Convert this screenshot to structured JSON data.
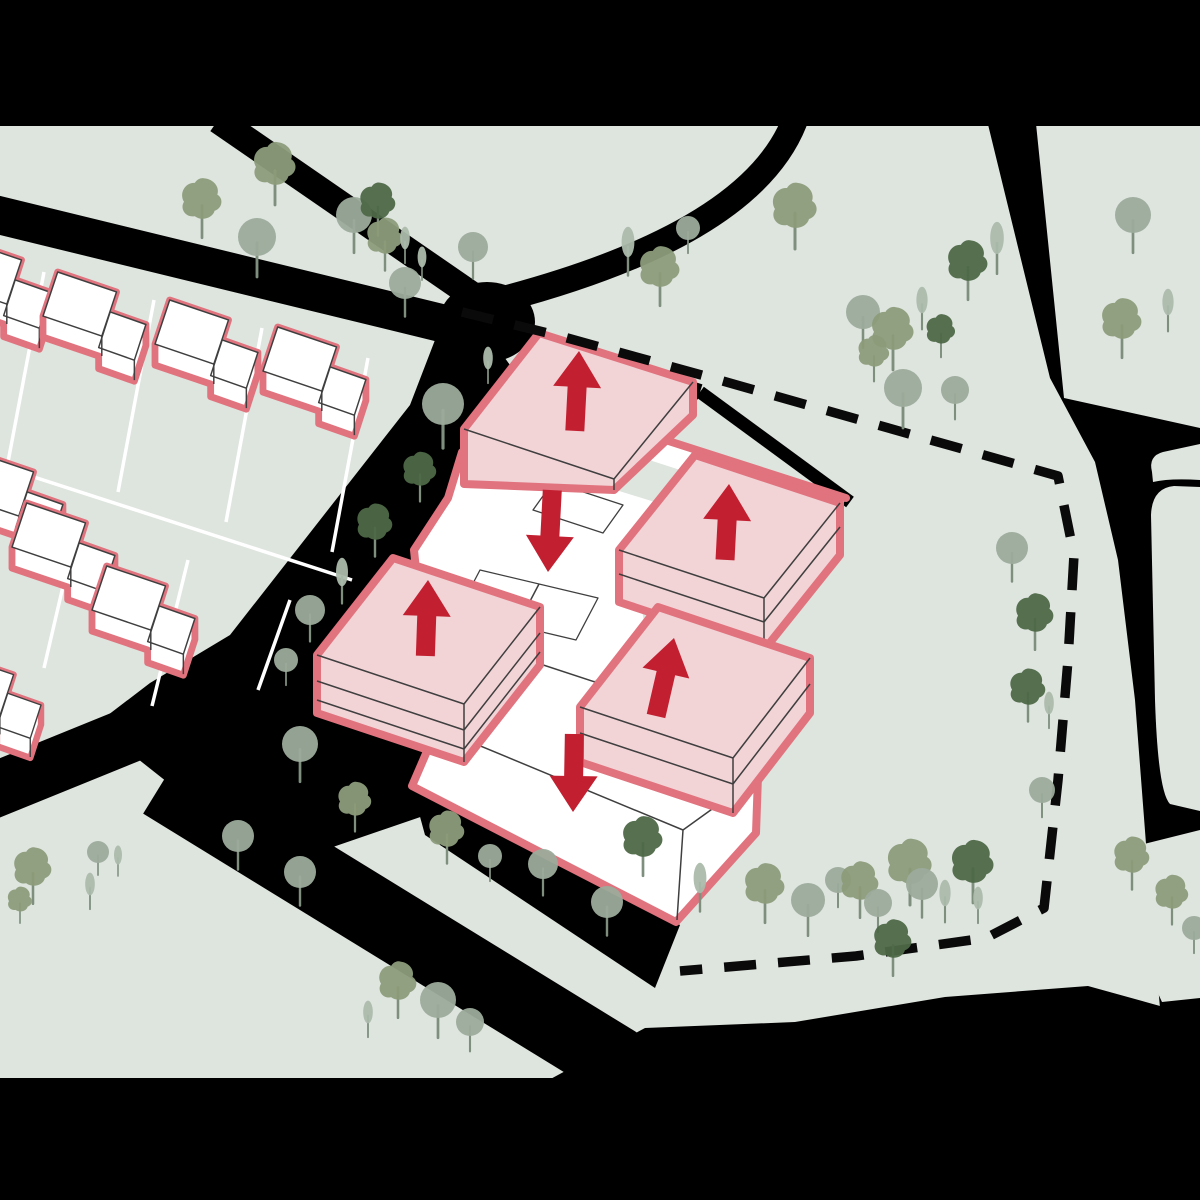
{
  "diagram": {
    "kind": "architectural-site-massing-diagram",
    "description": "Axonometric urban site diagram: existing houses outlined pink at top-left, a central school/cluster of massing blocks with red arrows (pink blocks = volumes added/up, white blocks = volumes reduced/down), dashed site boundary, black roads, scattered trees",
    "colors": {
      "ground": "#dee4de",
      "road": "#000000",
      "pink_fill": "#f2d3d6",
      "pink_outline": "#e0737e",
      "arrow_red": "#c22031",
      "white": "#ffffff",
      "line_dark": "#3f3f3f",
      "plot_line": "#ffffff",
      "boundary": "#0a0a0a",
      "tree_light": "#9cab9b",
      "tree_olive": "#8c9c7a",
      "tree_dark": "#4d6847",
      "tree_pale": "#abbaab",
      "trunk": "#7e8f7e"
    },
    "site_boundary": {
      "style": "dashed",
      "dash": [
        32,
        22
      ],
      "points": [
        [
          462,
          312
        ],
        [
          560,
          336
        ],
        [
          705,
          376
        ],
        [
          860,
          420
        ],
        [
          1058,
          476
        ],
        [
          1074,
          555
        ],
        [
          1068,
          660
        ],
        [
          1058,
          780
        ],
        [
          1044,
          908
        ],
        [
          986,
          938
        ],
        [
          856,
          956
        ],
        [
          680,
          971
        ]
      ]
    },
    "massing_blocks": [
      {
        "id": "block-north",
        "fill": "pink",
        "change": "up"
      },
      {
        "id": "block-east",
        "fill": "pink",
        "change": "up"
      },
      {
        "id": "block-west",
        "fill": "pink",
        "change": "up"
      },
      {
        "id": "block-southeast",
        "fill": "pink",
        "change": "up"
      },
      {
        "id": "podium-centre",
        "fill": "white",
        "change": "down"
      },
      {
        "id": "podium-south",
        "fill": "white",
        "change": "down"
      }
    ],
    "arrows": [
      {
        "block": "block-north",
        "dir": "up",
        "tip": [
          579,
          351
        ],
        "len": 80,
        "rot": 3
      },
      {
        "block": "block-east",
        "dir": "up",
        "tip": [
          729,
          484
        ],
        "len": 76,
        "rot": 3
      },
      {
        "block": "block-west",
        "dir": "up",
        "tip": [
          428,
          580
        ],
        "len": 76,
        "rot": 2
      },
      {
        "block": "block-southeast",
        "dir": "up",
        "tip": [
          674,
          638
        ],
        "len": 80,
        "rot": 13
      },
      {
        "block": "podium-centre",
        "dir": "down",
        "tip": [
          548,
          572
        ],
        "len": 82,
        "rot": 3
      },
      {
        "block": "podium-south",
        "dir": "down",
        "tip": [
          573,
          812
        ],
        "len": 78,
        "rot": 1
      }
    ],
    "houses": [
      {
        "x": -52,
        "y": 240,
        "s": 1.05
      },
      {
        "x": 43,
        "y": 272,
        "s": 1.05
      },
      {
        "x": 155,
        "y": 300,
        "s": 1.05
      },
      {
        "x": 263,
        "y": 327,
        "s": 1.05
      },
      {
        "x": -40,
        "y": 452,
        "s": 1.05
      },
      {
        "x": 12,
        "y": 503,
        "s": 1.05
      },
      {
        "x": 92,
        "y": 566,
        "s": 1.05
      },
      {
        "x": -55,
        "y": 656,
        "s": 0.98
      }
    ],
    "trees": [
      {
        "x": 202,
        "y": 200,
        "k": "blob",
        "s": 0.9
      },
      {
        "x": 275,
        "y": 165,
        "k": "blob",
        "s": 0.95
      },
      {
        "x": 257,
        "y": 237,
        "k": "round",
        "s": 0.95
      },
      {
        "x": 354,
        "y": 215,
        "k": "round",
        "s": 0.9
      },
      {
        "x": 378,
        "y": 202,
        "k": "blobdark",
        "s": 0.8
      },
      {
        "x": 385,
        "y": 237,
        "k": "blob",
        "s": 0.8
      },
      {
        "x": 405,
        "y": 238,
        "k": "column",
        "s": 0.6
      },
      {
        "x": 422,
        "y": 257,
        "k": "column",
        "s": 0.55
      },
      {
        "x": 473,
        "y": 247,
        "k": "round",
        "s": 0.75
      },
      {
        "x": 405,
        "y": 283,
        "k": "round",
        "s": 0.8
      },
      {
        "x": 628,
        "y": 242,
        "k": "column",
        "s": 0.8
      },
      {
        "x": 660,
        "y": 268,
        "k": "blob",
        "s": 0.9
      },
      {
        "x": 688,
        "y": 228,
        "k": "round",
        "s": 0.6
      },
      {
        "x": 795,
        "y": 207,
        "k": "blob",
        "s": 1.0
      },
      {
        "x": 968,
        "y": 262,
        "k": "blobdark",
        "s": 0.9
      },
      {
        "x": 997,
        "y": 238,
        "k": "column",
        "s": 0.85
      },
      {
        "x": 488,
        "y": 358,
        "k": "column",
        "s": 0.6
      },
      {
        "x": 1133,
        "y": 215,
        "k": "round",
        "s": 0.9
      },
      {
        "x": 1122,
        "y": 320,
        "k": "blob",
        "s": 0.9
      },
      {
        "x": 1168,
        "y": 302,
        "k": "column",
        "s": 0.7
      },
      {
        "x": 863,
        "y": 312,
        "k": "round",
        "s": 0.85
      },
      {
        "x": 893,
        "y": 330,
        "k": "blob",
        "s": 0.95
      },
      {
        "x": 922,
        "y": 300,
        "k": "column",
        "s": 0.7
      },
      {
        "x": 941,
        "y": 330,
        "k": "blobdark",
        "s": 0.65
      },
      {
        "x": 903,
        "y": 388,
        "k": "round",
        "s": 0.95
      },
      {
        "x": 955,
        "y": 390,
        "k": "round",
        "s": 0.7
      },
      {
        "x": 874,
        "y": 352,
        "k": "blob",
        "s": 0.7
      },
      {
        "x": 1012,
        "y": 548,
        "k": "round",
        "s": 0.8
      },
      {
        "x": 1035,
        "y": 614,
        "k": "blobdark",
        "s": 0.85
      },
      {
        "x": 1028,
        "y": 688,
        "k": "blobdark",
        "s": 0.8
      },
      {
        "x": 1049,
        "y": 703,
        "k": "column",
        "s": 0.6
      },
      {
        "x": 1042,
        "y": 790,
        "k": "round",
        "s": 0.65
      },
      {
        "x": 443,
        "y": 404,
        "k": "round",
        "s": 1.05
      },
      {
        "x": 420,
        "y": 470,
        "k": "blobdark",
        "s": 0.75
      },
      {
        "x": 375,
        "y": 523,
        "k": "blobdark",
        "s": 0.8
      },
      {
        "x": 342,
        "y": 572,
        "k": "column",
        "s": 0.75
      },
      {
        "x": 310,
        "y": 610,
        "k": "round",
        "s": 0.75
      },
      {
        "x": 286,
        "y": 660,
        "k": "round",
        "s": 0.6
      },
      {
        "x": 300,
        "y": 744,
        "k": "round",
        "s": 0.9
      },
      {
        "x": 355,
        "y": 800,
        "k": "blob",
        "s": 0.75
      },
      {
        "x": 447,
        "y": 830,
        "k": "blob",
        "s": 0.8
      },
      {
        "x": 490,
        "y": 856,
        "k": "round",
        "s": 0.6
      },
      {
        "x": 543,
        "y": 864,
        "k": "round",
        "s": 0.75
      },
      {
        "x": 607,
        "y": 902,
        "k": "round",
        "s": 0.8
      },
      {
        "x": 643,
        "y": 838,
        "k": "blobdark",
        "s": 0.9
      },
      {
        "x": 700,
        "y": 878,
        "k": "column",
        "s": 0.8
      },
      {
        "x": 765,
        "y": 885,
        "k": "blob",
        "s": 0.9
      },
      {
        "x": 808,
        "y": 900,
        "k": "round",
        "s": 0.85
      },
      {
        "x": 838,
        "y": 880,
        "k": "round",
        "s": 0.65
      },
      {
        "x": 860,
        "y": 882,
        "k": "blob",
        "s": 0.85
      },
      {
        "x": 878,
        "y": 903,
        "k": "round",
        "s": 0.7
      },
      {
        "x": 910,
        "y": 863,
        "k": "blob",
        "s": 1.0
      },
      {
        "x": 922,
        "y": 884,
        "k": "round",
        "s": 0.8
      },
      {
        "x": 945,
        "y": 893,
        "k": "column",
        "s": 0.7
      },
      {
        "x": 973,
        "y": 863,
        "k": "blobdark",
        "s": 0.95
      },
      {
        "x": 978,
        "y": 898,
        "k": "column",
        "s": 0.6
      },
      {
        "x": 893,
        "y": 940,
        "k": "blobdark",
        "s": 0.85
      },
      {
        "x": 1132,
        "y": 856,
        "k": "blob",
        "s": 0.8
      },
      {
        "x": 1172,
        "y": 893,
        "k": "blob",
        "s": 0.75
      },
      {
        "x": 1194,
        "y": 928,
        "k": "round",
        "s": 0.6
      },
      {
        "x": 33,
        "y": 868,
        "k": "blob",
        "s": 0.85
      },
      {
        "x": 98,
        "y": 852,
        "k": "round",
        "s": 0.55
      },
      {
        "x": 118,
        "y": 855,
        "k": "column",
        "s": 0.5
      },
      {
        "x": 238,
        "y": 836,
        "k": "round",
        "s": 0.8
      },
      {
        "x": 300,
        "y": 872,
        "k": "round",
        "s": 0.8
      },
      {
        "x": 90,
        "y": 884,
        "k": "column",
        "s": 0.6
      },
      {
        "x": 20,
        "y": 900,
        "k": "blob",
        "s": 0.55
      },
      {
        "x": 398,
        "y": 982,
        "k": "blob",
        "s": 0.85
      },
      {
        "x": 438,
        "y": 1000,
        "k": "round",
        "s": 0.9
      },
      {
        "x": 470,
        "y": 1022,
        "k": "round",
        "s": 0.7
      },
      {
        "x": 368,
        "y": 1012,
        "k": "column",
        "s": 0.6
      }
    ],
    "letterbox": {
      "top_height": 126,
      "bottom_y": 1078
    }
  }
}
